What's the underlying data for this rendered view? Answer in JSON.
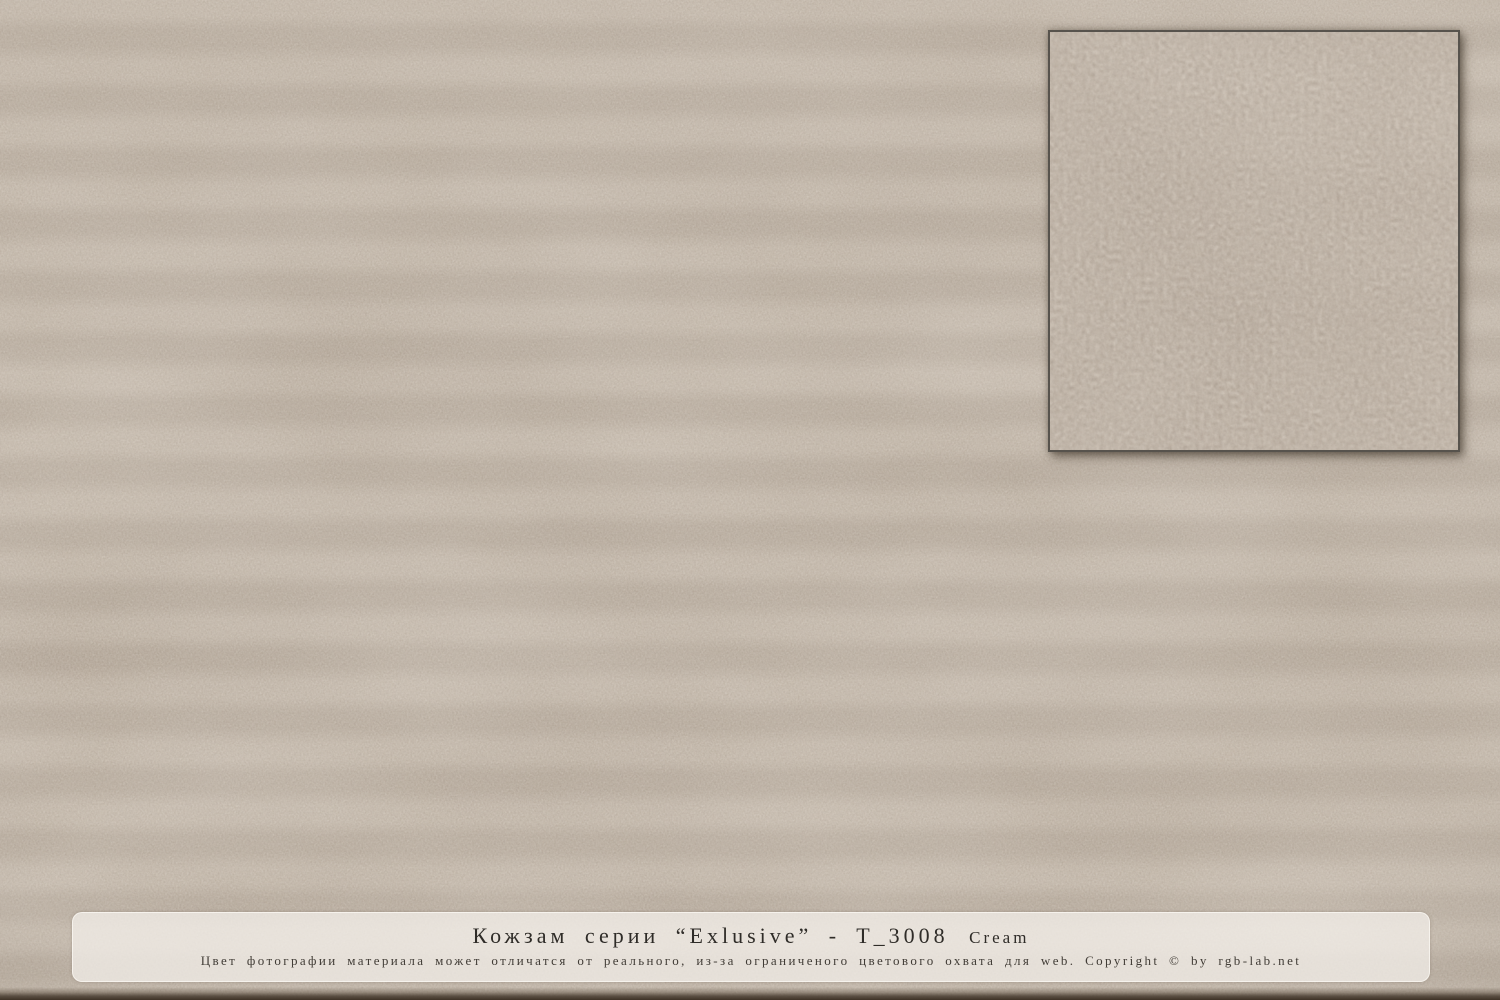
{
  "material_label": {
    "title_main": "Кожзам серии “Exlusive” - T_3008",
    "title_grade": "Cream",
    "disclaimer": "Цвет фотографии материала может отличатся от реального, из-за ограниченого цветового охвата для web. Copyright © by rgb-lab.net"
  },
  "colors": {
    "texture_base": "#b3a595",
    "texture_average": "#a7998c",
    "inset_base": "#a2958a",
    "inset_border": "#57534d",
    "caption_background": "rgba(243,239,233,0.75)",
    "title_text": "#2f2c28",
    "disclaimer_text": "#413c36",
    "bottom_edge": "#3e3226"
  }
}
